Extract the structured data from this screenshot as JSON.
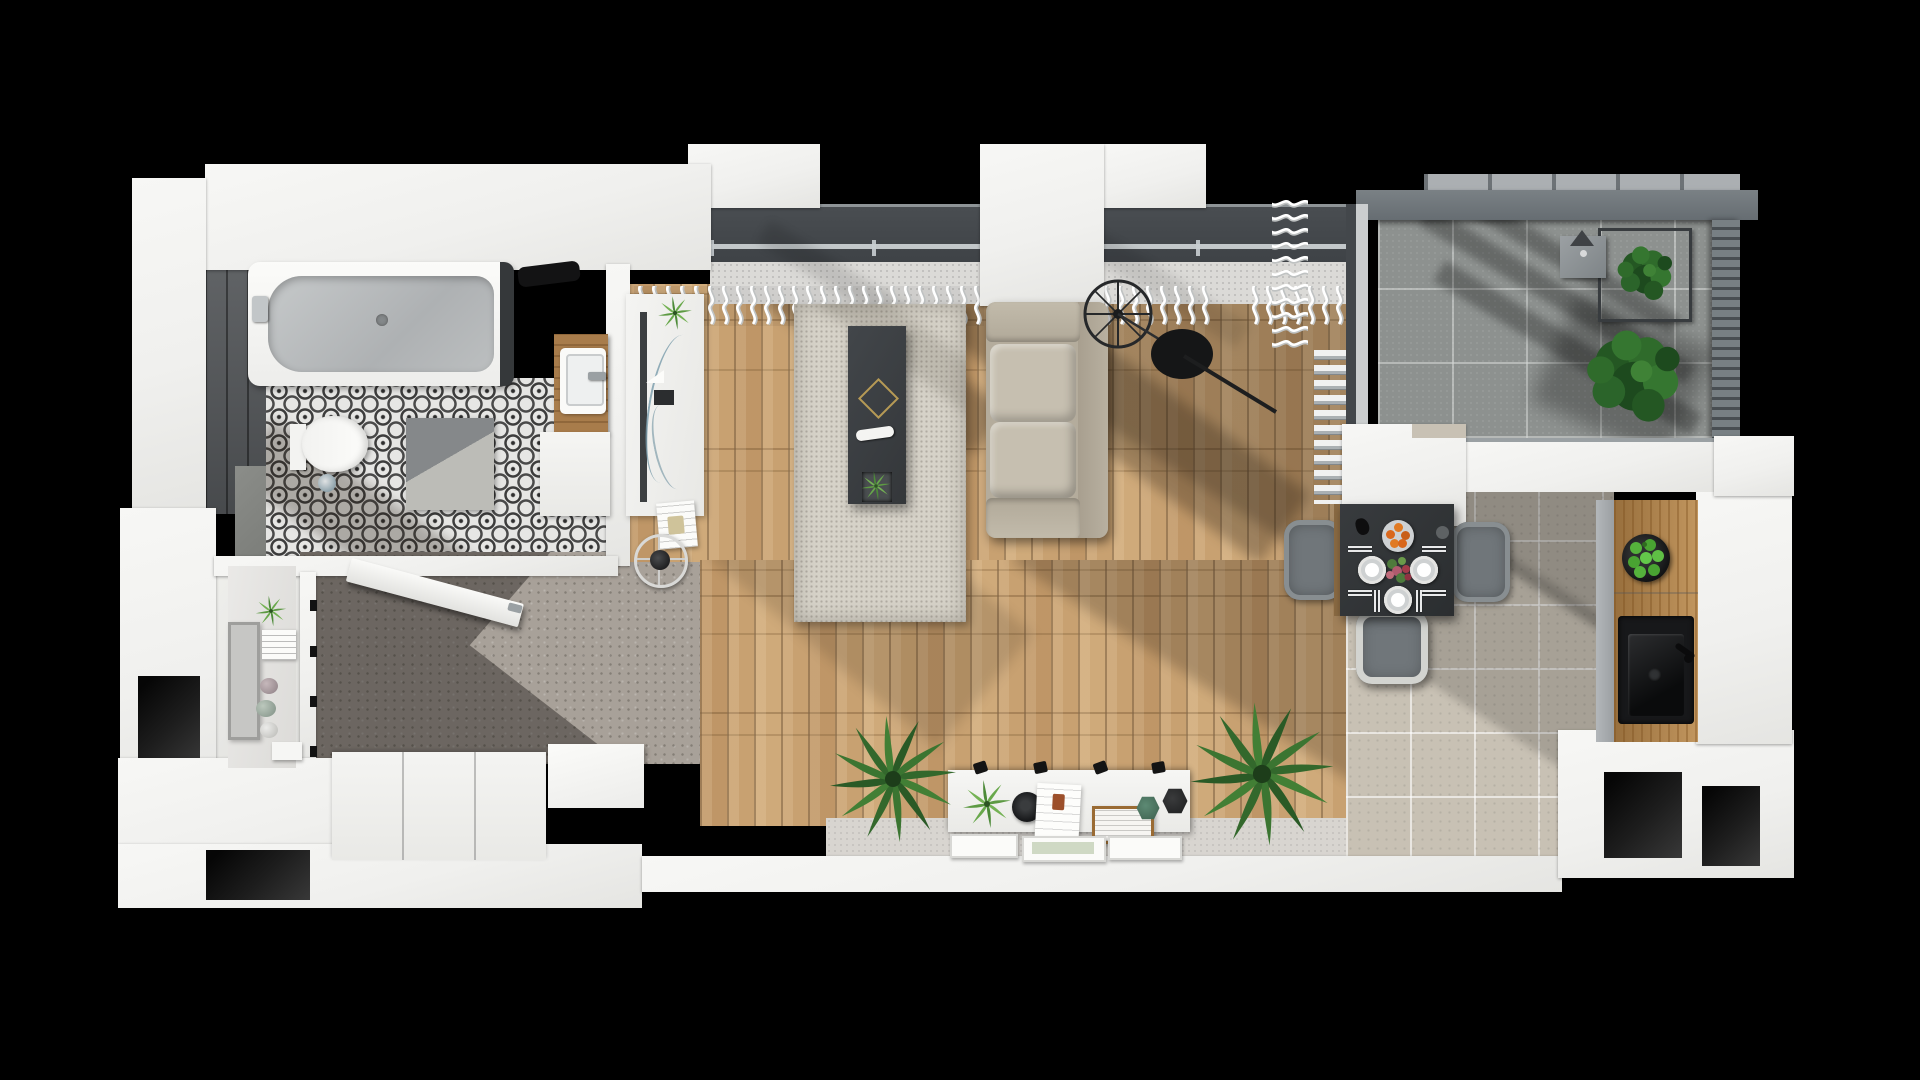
{
  "meta": {
    "title": "Top-down 3D render of an apartment floor plan",
    "canvas": {
      "width": 1920,
      "height": 1080,
      "background": "#000000"
    }
  },
  "palette": {
    "wall_white": "#f2f2f0",
    "wood_floor": "#c8a171",
    "hall_concrete": "#a8a199",
    "bathroom_tile_base": "#e6e6e4",
    "bathroom_tile_pattern": "#3c3c3c",
    "dark_tile_wall": "#54575a",
    "dining_tile": "#c8c1b4",
    "balcony_tile": "#8d918f",
    "rug": "#d6d2c8",
    "sofa": "#b4ac9c",
    "coffee_table": "#3a3d3f",
    "dining_table": "#303335",
    "chair_grey": "#70767a",
    "counter_wood": "#b28247",
    "plant_green": "#2f6b2b",
    "orange_accent": "#d9671c",
    "apple_green": "#55b23c"
  },
  "rooms": {
    "bathroom": {
      "label": "Bathroom",
      "items": [
        "bathtub",
        "wall-hung toilet",
        "washbasin on wooden shelf",
        "two-tone bath mat",
        "black-and-white patterned tile floor",
        "dark tiled wall",
        "black towel on tub edge"
      ]
    },
    "laundry": {
      "label": "Entry storage nook",
      "items": [
        "wall shelf",
        "potted plant",
        "posters",
        "decor stones",
        "tall leaning picture frame",
        "small white box"
      ]
    },
    "hallway": {
      "label": "Entrance hall",
      "items": [
        "open white door",
        "low white sideboards",
        "speckled concrete floor with shadow"
      ]
    },
    "living_room": {
      "label": "Living room",
      "items": [
        "white TV sideboard",
        "area rug",
        "dark coffee table",
        "beige two-seat sofa",
        "black spoke floor lamp",
        "white console with clip spotlights",
        "palm plants",
        "leaning picture frames",
        "sheer wavy curtains",
        "window wall at top"
      ]
    },
    "dining_area": {
      "label": "Dining area",
      "items": [
        "black dining table set for three",
        "grey upholstered chairs",
        "plate of oranges",
        "flower centrepiece",
        "white radiator",
        "white wall column"
      ]
    },
    "kitchen": {
      "label": "Kitchen",
      "items": [
        "wooden worktop",
        "black sink with tap",
        "black bowl of green apples"
      ]
    },
    "balcony": {
      "label": "Balcony",
      "items": [
        "large concrete tiles",
        "dark railing walls",
        "hanging plant in square stand",
        "large potted plant",
        "small lantern"
      ]
    }
  },
  "details": {
    "dining_plates": 3,
    "dining_chairs_visible": 3,
    "oranges_on_plate": 5,
    "apples_in_bowl": 8,
    "console_spotlights": 4,
    "sofa_seat_cushions": 2,
    "windows_side": "top",
    "render_style": "photoreal top-down cutaway, black void background"
  }
}
